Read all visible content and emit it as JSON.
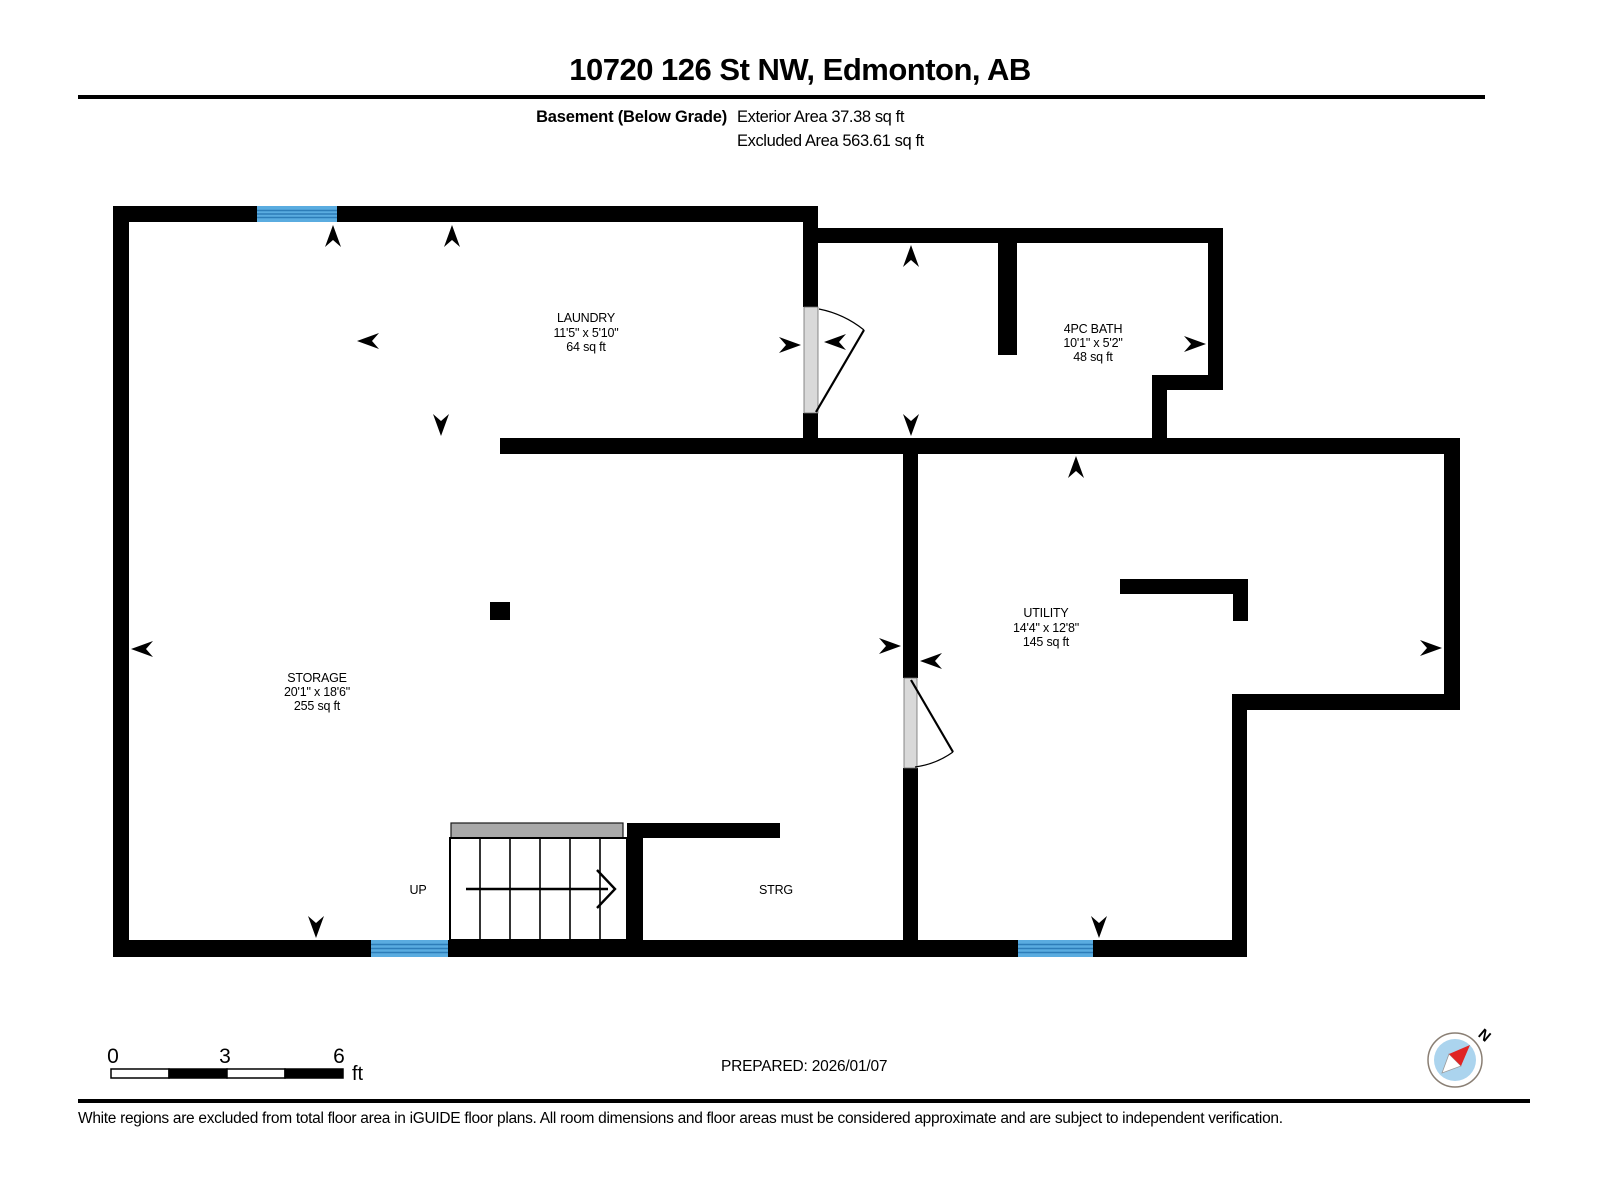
{
  "header": {
    "title": "10720 126 St NW, Edmonton, AB",
    "floor_label": "Basement (Below Grade)",
    "exterior_area": "Exterior Area 37.38 sq ft",
    "excluded_area": "Excluded Area 563.61 sq ft"
  },
  "rooms": {
    "laundry": {
      "name": "LAUNDRY",
      "dims": "11'5\" x 5'10\"",
      "area": "64 sq ft"
    },
    "bath": {
      "name": "4PC BATH",
      "dims": "10'1\" x 5'2\"",
      "area": "48 sq ft"
    },
    "storage": {
      "name": "STORAGE",
      "dims": "20'1\" x 18'6\"",
      "area": "255 sq ft"
    },
    "utility": {
      "name": "UTILITY",
      "dims": "14'4\" x 12'8\"",
      "area": "145 sq ft"
    }
  },
  "stairs": {
    "up_label": "UP"
  },
  "strg_label": "STRG",
  "scale_bar": {
    "tick_0": "0",
    "tick_3": "3",
    "tick_6": "6",
    "unit": "ft"
  },
  "prepared": "PREPARED: 2026/01/07",
  "compass": {
    "north": "N"
  },
  "disclaimer": "White regions are excluded from total floor area in iGUIDE floor plans. All room dimensions and floor areas must be considered approximate and are subject to independent verification.",
  "colors": {
    "wall": "#000000",
    "window_fill": "#5aace0",
    "window_line": "#2d7db8",
    "door_fill": "#d9d9d9",
    "stair_landing": "#a9a9a9",
    "compass_fill": "#abd4ee",
    "compass_needle": "#e02424"
  }
}
